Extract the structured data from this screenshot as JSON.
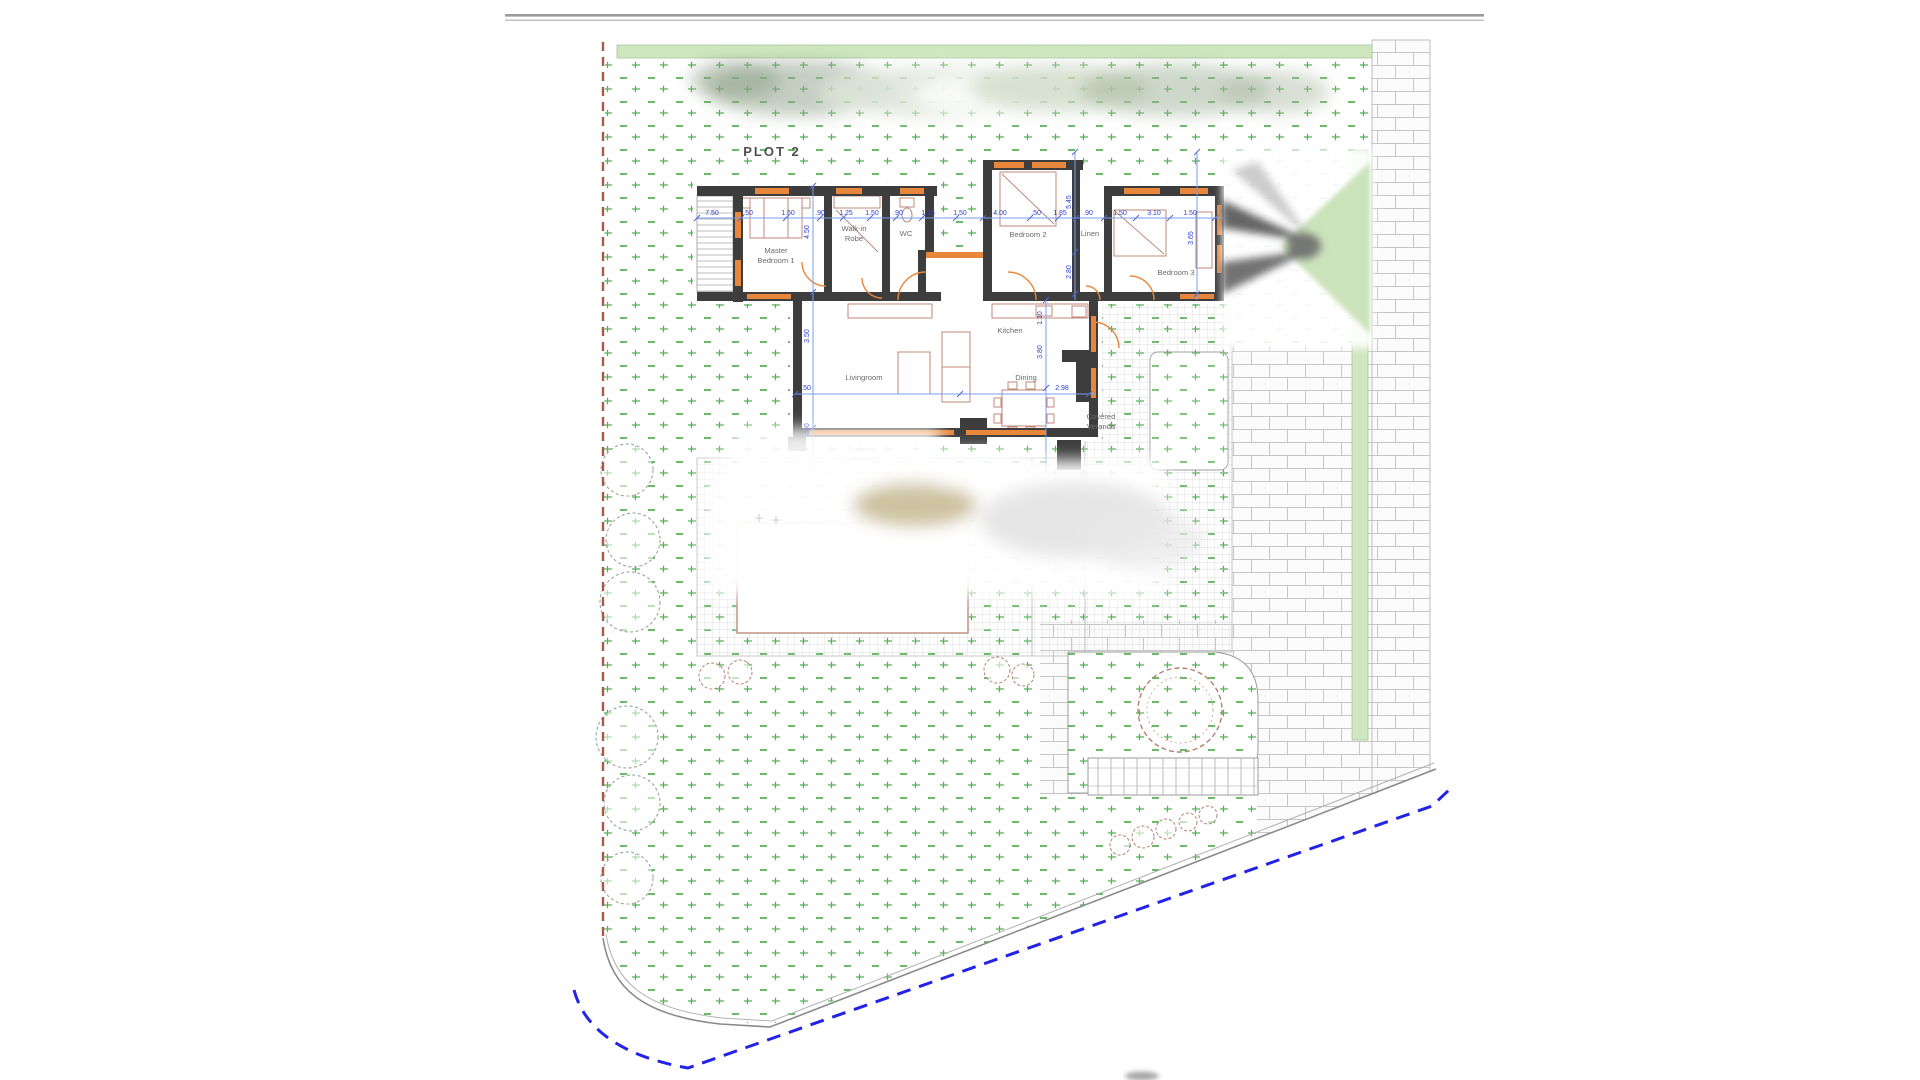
{
  "plan": {
    "plot_label": "PLOT 2",
    "rooms": {
      "master": {
        "line1": "Master",
        "line2": "Bedroom 1"
      },
      "robe": {
        "line1": "Walk-in",
        "line2": "Robe"
      },
      "wc": {
        "label": "WC"
      },
      "bedroom2": {
        "label": "Bedroom 2"
      },
      "linen": {
        "label": "Linen"
      },
      "bedroom3": {
        "label": "Bedroom 3"
      },
      "living": {
        "label": "Livingroom"
      },
      "kitchen": {
        "label": "Kitchen"
      },
      "dining": {
        "label": "Dining"
      },
      "veranda_south": {
        "line1": "Covered",
        "line2": "Veranda"
      },
      "veranda_east": {
        "line1": "Covered",
        "line2": "Veranda"
      }
    },
    "dimensions": {
      "top_row": [
        "7.50",
        ".50",
        "1.50",
        ".90",
        "1.25",
        "1.50",
        ".90",
        "1.25",
        "1.50",
        "4.00",
        ".50",
        "1.85",
        ".90",
        "1.50",
        "3.10",
        "1.50",
        ".50"
      ],
      "left_column": [
        "4.50",
        "3.50",
        "5.00"
      ],
      "right_column": [
        "5.45",
        "2.80",
        "1.10",
        "3.80",
        "3.15"
      ],
      "living_width": "2.98",
      "living_height": "3.65",
      "porch_width": ".50"
    },
    "colors": {
      "grass_mark": "#4fae4f",
      "greenbelt": "#cfe7bf",
      "wall": "#3d3d3d",
      "window": "#e8873b",
      "furniture": "#c08878",
      "dimension_text": "#2b3fd6",
      "dimension_line": "#7b9ce8",
      "plot_edge_dashed": "#a65a48",
      "setback_dashed_blue": "#2323e8",
      "brick_line": "#c6c6c6"
    }
  }
}
